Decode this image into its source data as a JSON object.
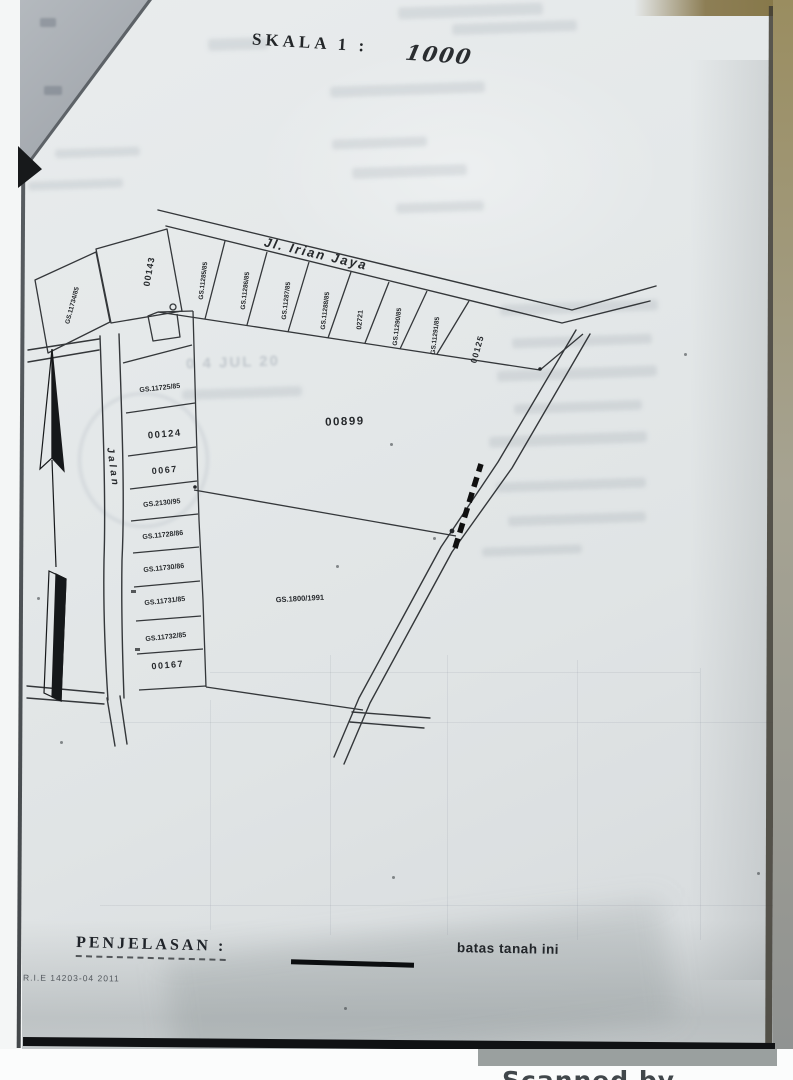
{
  "doc": {
    "scale_label": "SKALA 1 :",
    "scale_value": "1000"
  },
  "map": {
    "road_top": "Jl. Irian Jaya",
    "road_left": "Jalan",
    "parcel_00143": "00143",
    "parcel_11734": "GS.11734/85",
    "strip": [
      "GS.11285/85",
      "GS.11286/85",
      "GS.11287/85",
      "GS.11288/85",
      "02721",
      "GS.11290/85",
      "GS.11291/85"
    ],
    "parcel_00125": "00125",
    "left_column": [
      "GS.11725/85",
      "00124",
      "0067",
      "GS.2130/95",
      "GS.11728/86",
      "GS.11730/86",
      "GS.11731/85",
      "GS.11732/85",
      "00167"
    ],
    "parcel_00899": "00899",
    "parcel_1800": "GS.1800/1991"
  },
  "legend": {
    "title": "PENJELASAN :",
    "item": "batas tanah ini"
  },
  "footer": {
    "ref": "R.I.E 14203-04 2011",
    "watermark": "Scanned by TapScanner"
  },
  "ghost": {
    "stamp": "0 4 JUL 20"
  }
}
